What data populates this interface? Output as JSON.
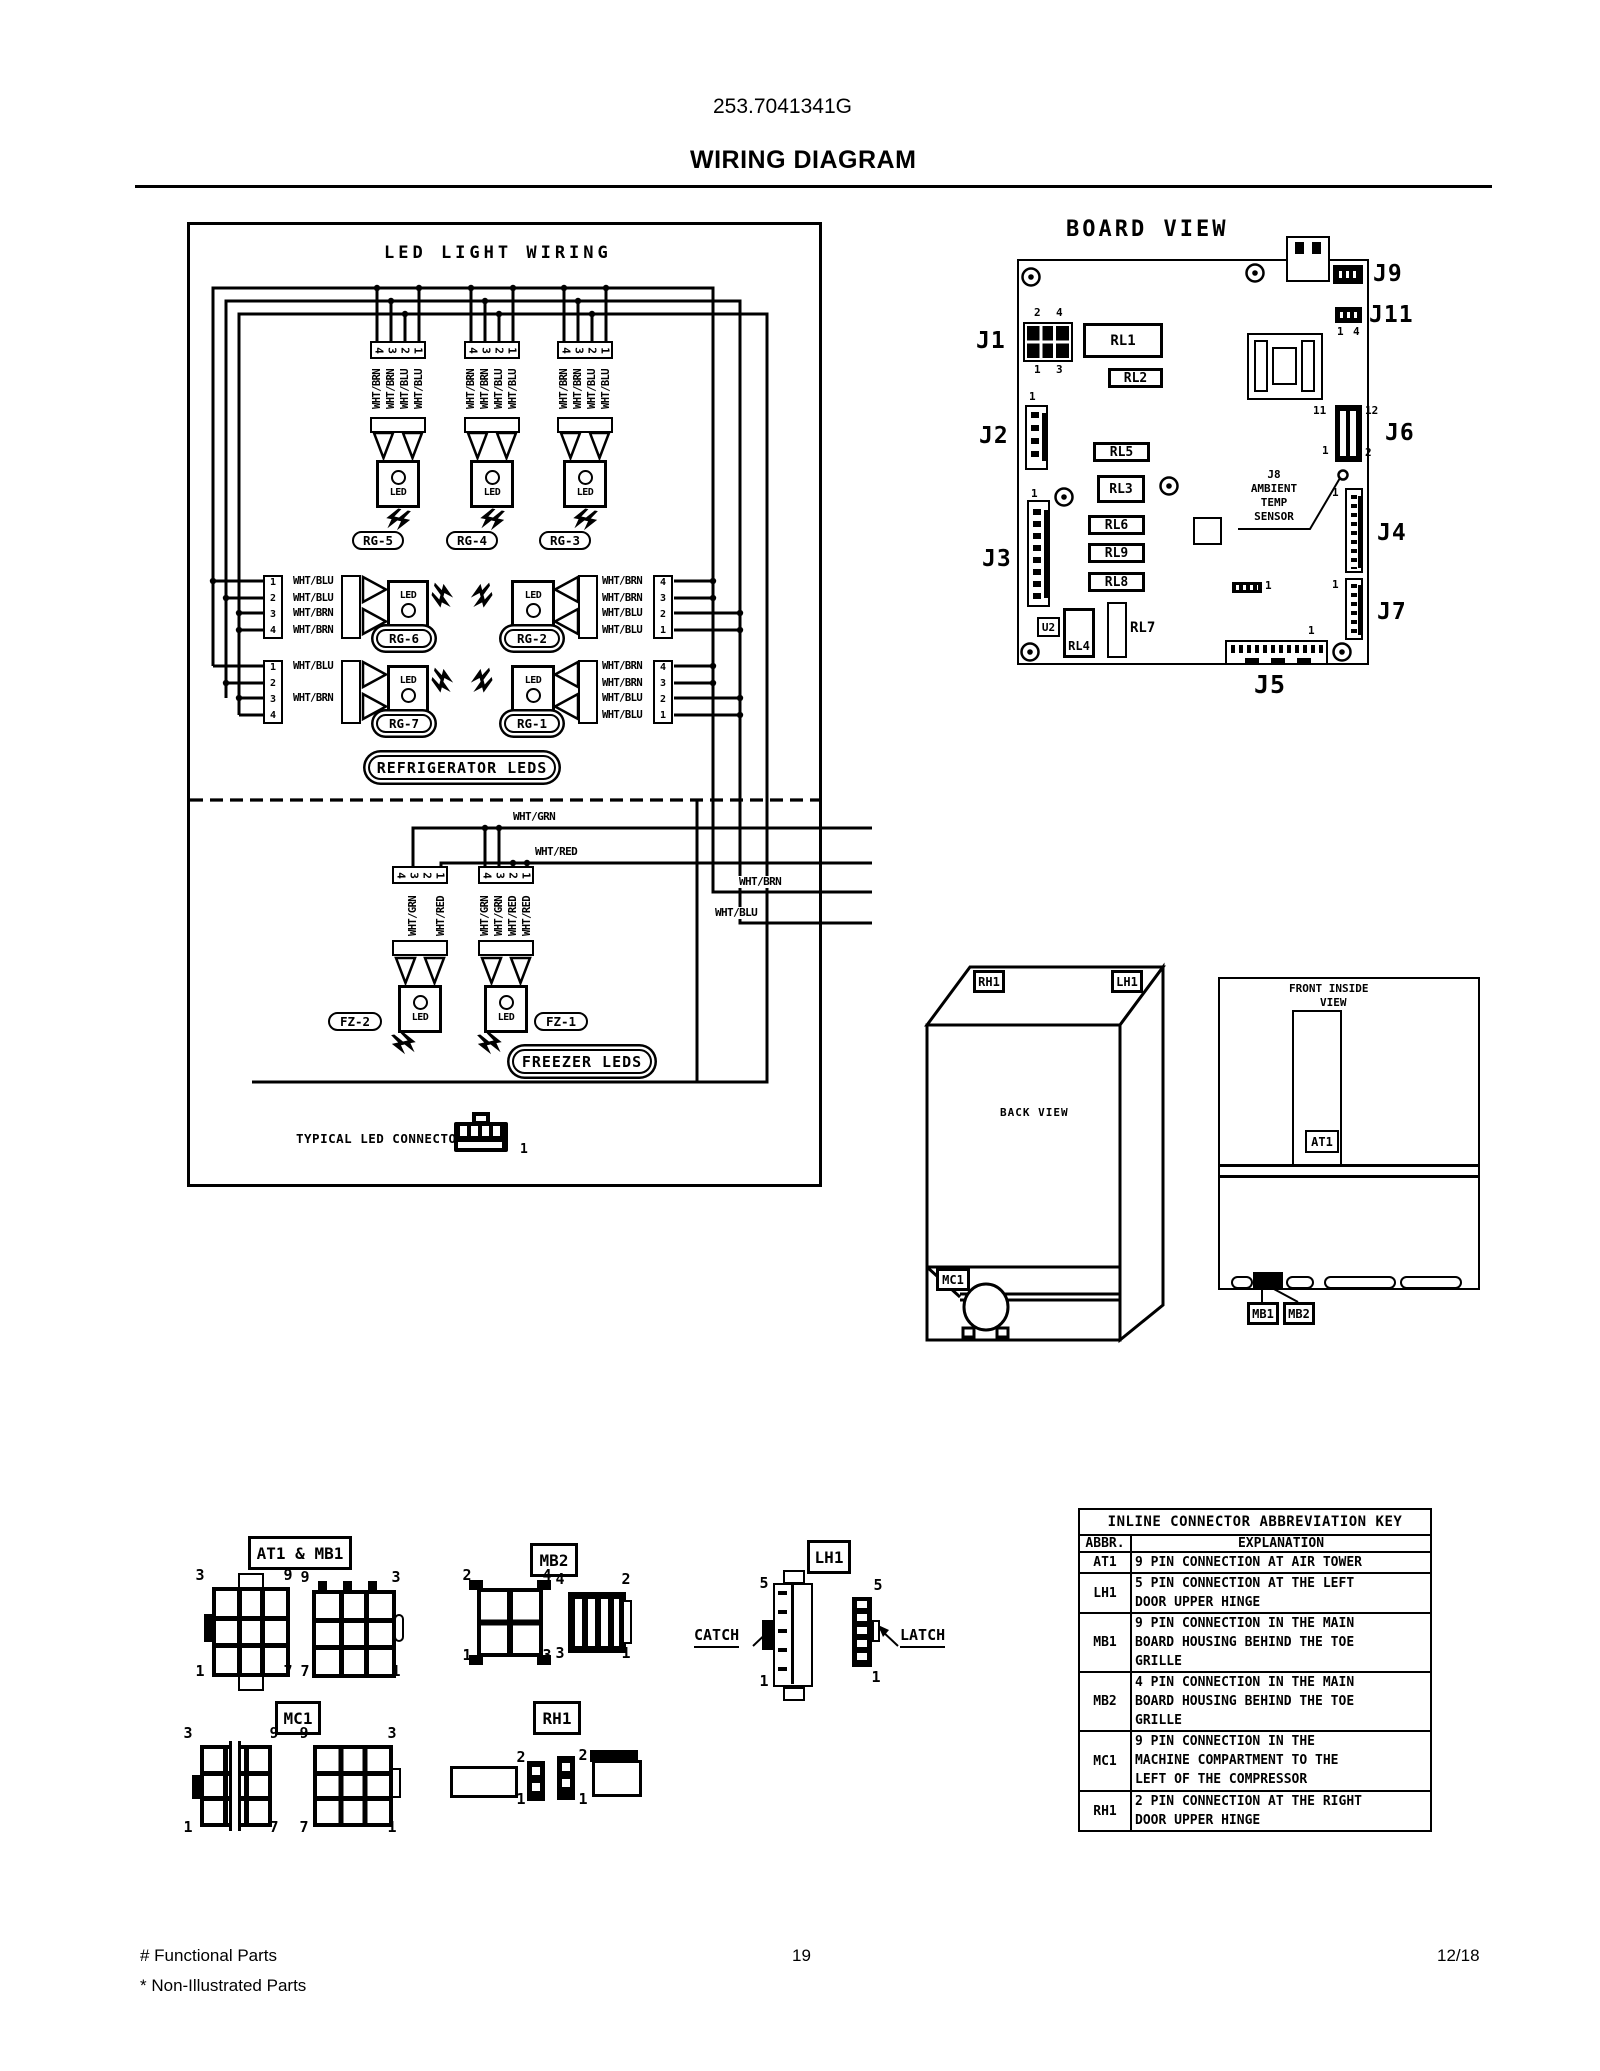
{
  "page": {
    "model_number": "253.7041341G",
    "title": "WIRING DIAGRAM",
    "page_number": "19",
    "revision_date": "12/18",
    "footnote_functional": "# Functional Parts",
    "footnote_non_illustrated": "* Non-Illustrated Parts"
  },
  "icons": {
    "light_emission": "double-lightning",
    "screw": "screw-hole",
    "compressor": "compressor",
    "led_connector": "4-pin-led-connector"
  },
  "led_panel": {
    "title": "LED LIGHT WIRING",
    "led_text": "LED",
    "pins_desc": [
      "4",
      "3",
      "2",
      "1"
    ],
    "pins_asc": [
      "1",
      "2",
      "3",
      "4"
    ],
    "top_groups": [
      {
        "name": "RG-5",
        "wires": [
          "WHT/BRN",
          "WHT/BRN",
          "WHT/BLU",
          "WHT/BLU"
        ]
      },
      {
        "name": "RG-4",
        "wires": [
          "WHT/BRN",
          "WHT/BRN",
          "WHT/BLU",
          "WHT/BLU"
        ]
      },
      {
        "name": "RG-3",
        "wires": [
          "WHT/BRN",
          "WHT/BRN",
          "WHT/BLU",
          "WHT/BLU"
        ]
      }
    ],
    "left_groups": [
      {
        "name": "RG-6",
        "wires": [
          "WHT/BLU",
          "WHT/BLU",
          "WHT/BRN",
          "WHT/BRN"
        ]
      },
      {
        "name": "RG-7",
        "wires": [
          "WHT/BLU",
          "",
          "WHT/BRN",
          ""
        ]
      }
    ],
    "right_groups": [
      {
        "name": "RG-2",
        "wires": [
          "WHT/BRN",
          "WHT/BRN",
          "WHT/BLU",
          "WHT/BLU"
        ]
      },
      {
        "name": "RG-1",
        "wires": [
          "WHT/BRN",
          "WHT/BRN",
          "WHT/BLU",
          "WHT/BLU"
        ]
      }
    ],
    "freezer_groups": [
      {
        "name": "FZ-2",
        "wires": [
          "",
          "WHT/GRN",
          "",
          "WHT/RED"
        ]
      },
      {
        "name": "FZ-1",
        "wires": [
          "WHT/GRN",
          "WHT/GRN",
          "WHT/RED",
          "WHT/RED"
        ]
      }
    ],
    "bus_labels": {
      "grn": "WHT/GRN",
      "red": "WHT/RED",
      "brn": "WHT/BRN",
      "blu": "WHT/BLU"
    },
    "refrigerator_label": "REFRIGERATOR LEDS",
    "freezer_label": "FREEZER LEDS",
    "typical_connector_label": "TYPICAL LED CONNECTOR",
    "typical_connector_pin": "1"
  },
  "board": {
    "title": "BOARD VIEW",
    "labels": {
      "j1": "J1",
      "j2": "J2",
      "j3": "J3",
      "j4": "J4",
      "j5": "J5",
      "j6": "J6",
      "j7": "J7",
      "j9": "J9",
      "j11": "J11"
    },
    "relays": {
      "rl1": "RL1",
      "rl2": "RL2",
      "rl3": "RL3",
      "rl4": "RL4",
      "rl5": "RL5",
      "rl6": "RL6",
      "rl7": "RL7",
      "rl8": "RL8",
      "rl9": "RL9"
    },
    "u2": "U2",
    "j8_sensor_lines": [
      "J8",
      "AMBIENT",
      "TEMP",
      "SENSOR"
    ],
    "pins": {
      "j1_tl": "2",
      "j1_tr": "4",
      "j1_bl": "1",
      "j1_br": "3",
      "j2_top": "1",
      "j3_top": "1",
      "j11_l": "1",
      "j11_r": "4",
      "j6_tl": "11",
      "j6_tr": "12",
      "j6_bl": "1",
      "j6_br": "2",
      "j4_top": "1",
      "j7_top": "1",
      "j5_right": "1",
      "aux": "1"
    }
  },
  "back_view": {
    "title": "BACK VIEW",
    "rh1": "RH1",
    "lh1": "LH1",
    "mc1": "MC1"
  },
  "front_view": {
    "title_line1": "FRONT INSIDE",
    "title_line2": "VIEW",
    "at1": "AT1",
    "mb1": "MB1",
    "mb2": "MB2"
  },
  "figures": {
    "at1_mb1": {
      "label": "AT1 & MB1",
      "a": {
        "tl": "3",
        "tr": "9",
        "bl": "1",
        "br": "7"
      },
      "b": {
        "tl": "9",
        "tr": "3",
        "bl": "7",
        "br": "1"
      }
    },
    "mb2": {
      "label": "MB2",
      "a": {
        "tl": "2",
        "tr": "4",
        "bl": "1",
        "br": "3"
      },
      "b": {
        "tl": "4",
        "tr": "2",
        "bl": "3",
        "br": "1"
      }
    },
    "lh1": {
      "label": "LH1",
      "catch": "CATCH",
      "latch": "LATCH",
      "a": {
        "top": "5",
        "bottom": "1"
      },
      "b": {
        "top": "5",
        "bottom": "1"
      }
    },
    "mc1": {
      "label": "MC1",
      "a": {
        "tl": "3",
        "tr": "9",
        "bl": "1",
        "br": "7"
      },
      "b": {
        "tl": "9",
        "tr": "3",
        "bl": "7",
        "br": "1"
      }
    },
    "rh1": {
      "label": "RH1",
      "a": {
        "top": "2",
        "bottom": "1"
      },
      "b": {
        "top": "2",
        "bottom": "1"
      }
    }
  },
  "key_table": {
    "title": "INLINE CONNECTOR ABBREVIATION KEY",
    "col_abbr": "ABBR.",
    "col_expl": "EXPLANATION",
    "rows": [
      {
        "abbr": "AT1",
        "lines": [
          "9 PIN CONNECTION AT AIR TOWER"
        ]
      },
      {
        "abbr": "LH1",
        "lines": [
          "5 PIN CONNECTION AT THE LEFT",
          "DOOR UPPER HINGE"
        ]
      },
      {
        "abbr": "MB1",
        "lines": [
          "9 PIN CONNECTION IN THE MAIN",
          "BOARD HOUSING BEHIND THE TOE",
          "GRILLE"
        ]
      },
      {
        "abbr": "MB2",
        "lines": [
          "4 PIN CONNECTION IN THE MAIN",
          "BOARD HOUSING BEHIND THE TOE",
          "GRILLE"
        ]
      },
      {
        "abbr": "MC1",
        "lines": [
          "9 PIN CONNECTION IN THE",
          "MACHINE COMPARTMENT TO THE",
          "LEFT OF THE COMPRESSOR"
        ]
      },
      {
        "abbr": "RH1",
        "lines": [
          "2 PIN CONNECTION AT THE RIGHT",
          "DOOR UPPER HINGE"
        ]
      }
    ]
  }
}
